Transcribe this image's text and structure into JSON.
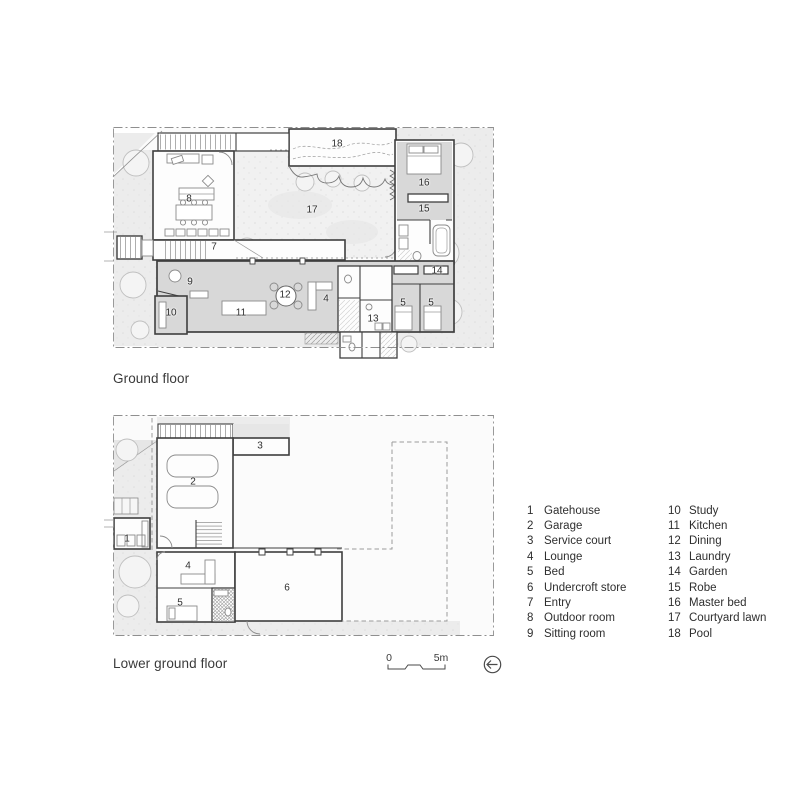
{
  "ground_floor": {
    "title": "Ground floor",
    "rooms": [
      {
        "n": "18",
        "x": 337,
        "y": 144
      },
      {
        "n": "17",
        "x": 312,
        "y": 210
      },
      {
        "n": "16",
        "x": 424,
        "y": 183
      },
      {
        "n": "15",
        "x": 424,
        "y": 209
      },
      {
        "n": "14",
        "x": 437,
        "y": 271
      },
      {
        "n": "8",
        "x": 189,
        "y": 199
      },
      {
        "n": "7",
        "x": 214,
        "y": 247
      },
      {
        "n": "9",
        "x": 190,
        "y": 282
      },
      {
        "n": "10",
        "x": 171,
        "y": 313
      },
      {
        "n": "11",
        "x": 241,
        "y": 313
      },
      {
        "n": "12",
        "x": 285,
        "y": 295
      },
      {
        "n": "4",
        "x": 326,
        "y": 299
      },
      {
        "n": "13",
        "x": 373,
        "y": 319
      },
      {
        "n": "5",
        "x": 403,
        "y": 303
      },
      {
        "n": "5",
        "x": 431,
        "y": 303
      }
    ]
  },
  "lower_floor": {
    "title": "Lower ground floor",
    "rooms": [
      {
        "n": "3",
        "x": 260,
        "y": 446
      },
      {
        "n": "2",
        "x": 193,
        "y": 482
      },
      {
        "n": "1",
        "x": 127,
        "y": 539
      },
      {
        "n": "4",
        "x": 188,
        "y": 566
      },
      {
        "n": "5",
        "x": 180,
        "y": 603
      },
      {
        "n": "6",
        "x": 287,
        "y": 588
      }
    ]
  },
  "legend": {
    "column1": [
      {
        "num": "1",
        "label": "Gatehouse"
      },
      {
        "num": "2",
        "label": "Garage"
      },
      {
        "num": "3",
        "label": "Service court"
      },
      {
        "num": "4",
        "label": "Lounge"
      },
      {
        "num": "5",
        "label": "Bed"
      },
      {
        "num": "6",
        "label": "Undercroft store"
      },
      {
        "num": "7",
        "label": "Entry"
      },
      {
        "num": "8",
        "label": "Outdoor room"
      },
      {
        "num": "9",
        "label": "Sitting room"
      }
    ],
    "column2": [
      {
        "num": "10",
        "label": "Study"
      },
      {
        "num": "11",
        "label": "Kitchen"
      },
      {
        "num": "12",
        "label": "Dining"
      },
      {
        "num": "13",
        "label": "Laundry"
      },
      {
        "num": "14",
        "label": "Garden"
      },
      {
        "num": "15",
        "label": "Robe"
      },
      {
        "num": "16",
        "label": "Master bed"
      },
      {
        "num": "17",
        "label": "Courtyard lawn"
      },
      {
        "num": "18",
        "label": "Pool"
      }
    ]
  },
  "scale_bar": {
    "zero_label": "0",
    "end_label": "5m"
  },
  "icons": {
    "north_arrow": "circle-left-arrow-icon"
  },
  "colors": {
    "wall": "#3f3f3f",
    "room_gray": "#d8d8d8",
    "garden": "#ececec",
    "tree_stroke": "#bfbfbf",
    "text": "#2f2f2f",
    "boundary": "#8f8f8f"
  }
}
